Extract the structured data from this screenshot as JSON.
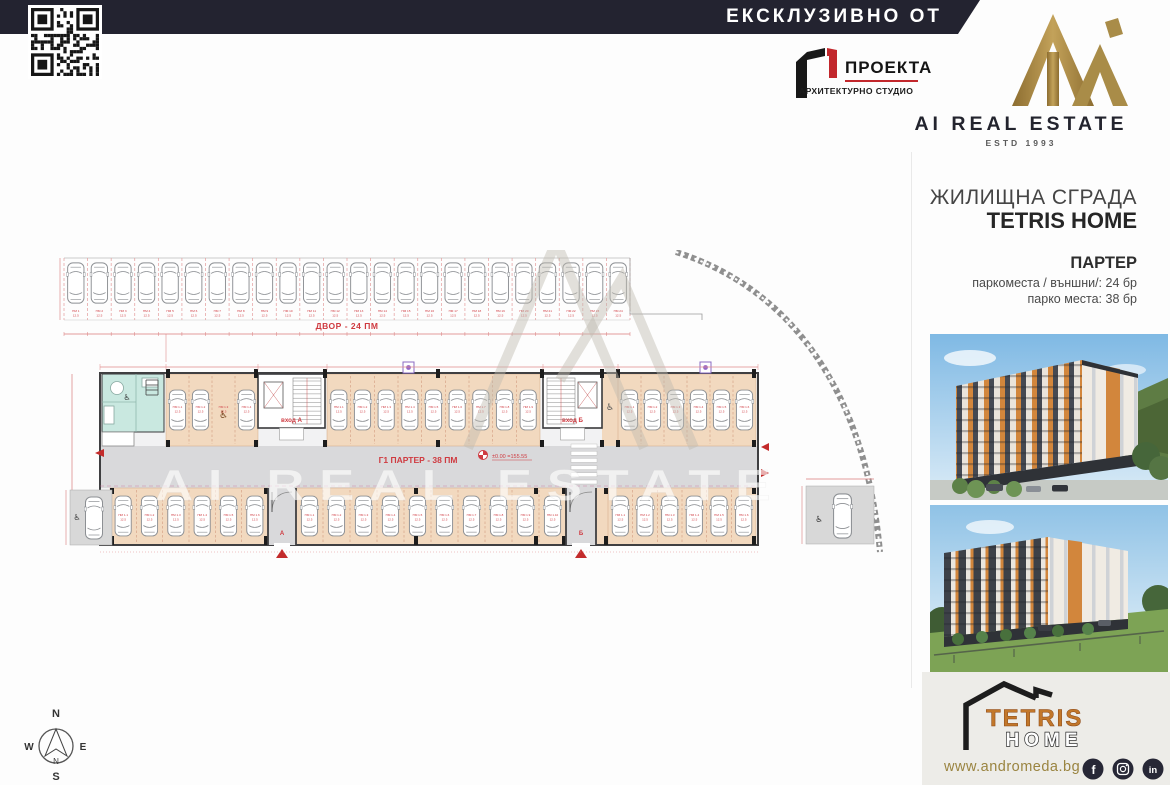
{
  "top_bar": {
    "label": "ЕКСКЛУЗИВНО ОТ",
    "bg": "#232330"
  },
  "architect": {
    "name": "ПРОЕКТА",
    "subtitle": "АРХИТЕКТУРНО СТУДИО"
  },
  "brand": {
    "name": "AI REAL ESTATE",
    "estd": "ESTD 1993",
    "gold": "#a4843e",
    "navy": "#23242e"
  },
  "sidebar": {
    "building_type": "ЖИЛИЩНА СГРАДА",
    "building_name": "TETRIS HOME",
    "floor": "ПАРТЕР",
    "line1": "паркоместа / външни/: 24 бр",
    "line2": "парко места: 38 бр"
  },
  "plan": {
    "yard_label": "ДВОР - 24 ПМ",
    "garage_label": "Г1  ПАРТЕР - 38 ПМ",
    "level_label": "±0.00 =155.55",
    "entrance_a": "вход А",
    "entrance_b": "вход Б",
    "exit_a": "А",
    "exit_b": "Б",
    "stall_prefix": "ПМ",
    "stall_area": "12.5",
    "yard_stalls": 24,
    "garage_stalls": 38,
    "watermark": "AI REAL ESTATE",
    "red": "#cf3a40"
  },
  "compass": {
    "n": "N",
    "s": "S",
    "e": "E",
    "w": "W"
  },
  "footer": {
    "logo_name": "TETRIS",
    "logo_home": "HOME",
    "website": "www.andromeda.bg",
    "social": [
      "facebook",
      "instagram",
      "linkedin"
    ]
  }
}
